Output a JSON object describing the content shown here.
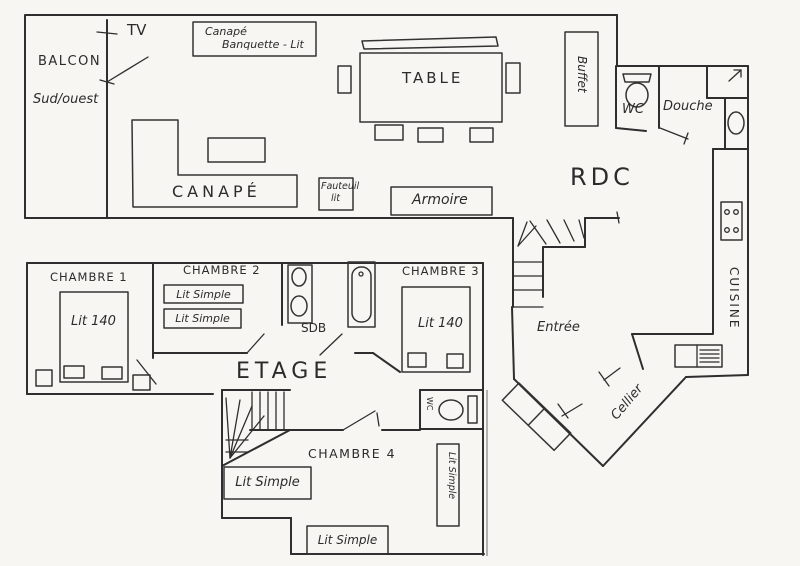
{
  "document": {
    "type": "hand-drawn apartment floor plan (scan)",
    "floors": [
      "RDC",
      "ETAGE"
    ]
  },
  "colors": {
    "paper": "#f7f6f2",
    "ink": "#2e2e2e"
  },
  "rdc": {
    "label": "RDC",
    "balcony": {
      "name": "BALCON",
      "orientation": "Sud/ouest"
    },
    "tv": "TV",
    "sofa_bed_box": {
      "line1": "Canapé",
      "line2": "Banquette - Lit"
    },
    "table": "TABLE",
    "buffet": "Buffet",
    "sofa": "CANAPÉ",
    "armchair": {
      "line1": "Fauteuil",
      "line2": "lit"
    },
    "wardrobe": "Armoire",
    "wc": "WC",
    "shower": "Douche",
    "kitchen": "CUISINE",
    "entrance": "Entrée",
    "cellar": "Cellier"
  },
  "etage": {
    "label": "ETAGE",
    "bedroom1": {
      "name": "CHAMBRE 1",
      "bed": "Lit 140"
    },
    "bedroom2": {
      "name": "CHAMBRE 2",
      "bed1": "Lit Simple",
      "bed2": "Lit Simple"
    },
    "bathroom": "SDB",
    "bedroom3": {
      "name": "CHAMBRE 3",
      "bed": "Lit 140"
    },
    "wc": "WC",
    "bedroom4": {
      "name": "CHAMBRE 4",
      "bed_left": "Lit Simple",
      "bed_bottom": "Lit Simple",
      "bed_right": "Lit Simple"
    }
  }
}
